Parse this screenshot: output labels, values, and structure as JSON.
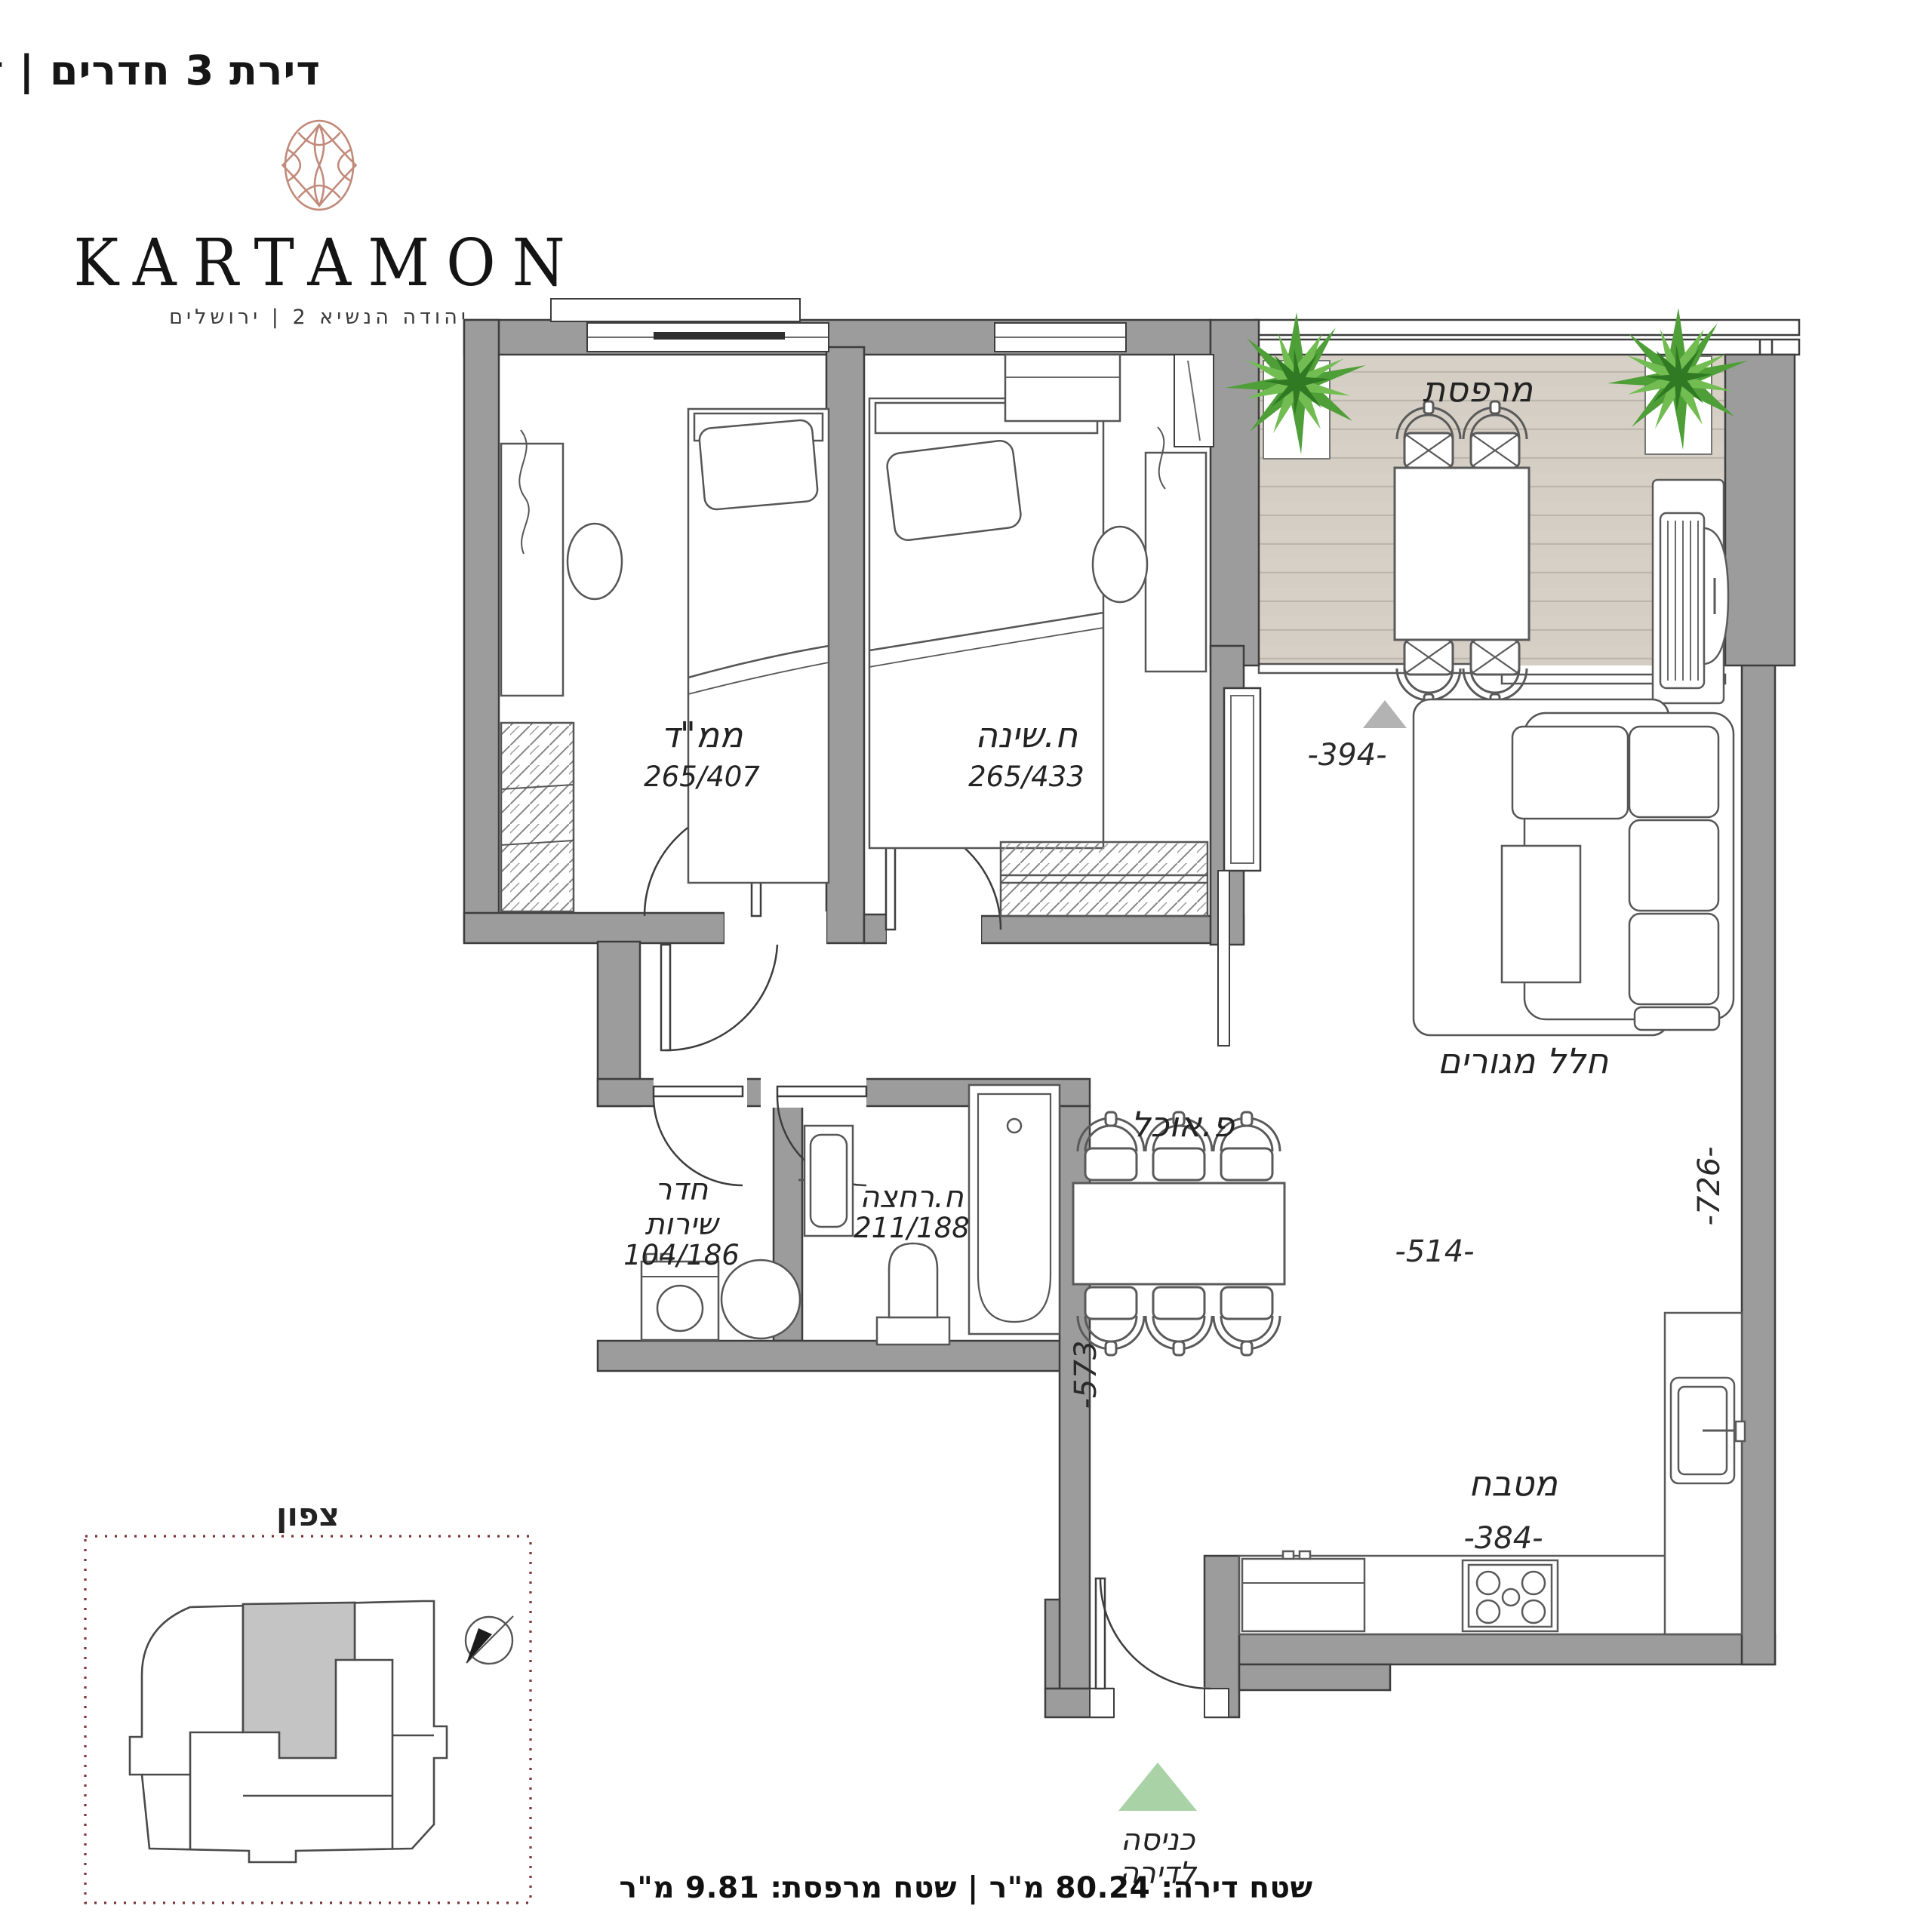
{
  "header": {
    "title": "דירת 3 חדרים | דגם A"
  },
  "logo": {
    "name": "KARTAMON",
    "subtitle": "יהודה הנשיא 2  |  ירושלים",
    "rosette_icon": "rosette-icon",
    "rosette_color": "#c18a7a"
  },
  "plan": {
    "rooms": {
      "mamad": {
        "name": "ממ\"ד",
        "dims": "265/407"
      },
      "bedroom": {
        "name": "ח.שינה",
        "dims": "265/433"
      },
      "balcony": {
        "name": "מרפסת"
      },
      "living": {
        "name": "חלל מגורים"
      },
      "dining": {
        "name": "פ.אוכל"
      },
      "utility": {
        "name_line1": "חדר",
        "name_line2": "שירות",
        "dims": "104/186"
      },
      "bath": {
        "name": "ח.רחצה",
        "dims": "211/188"
      },
      "kitchen": {
        "name": "מטבח"
      }
    },
    "dimensions": {
      "balcony_opening": "-394-",
      "living_depth": "-726-",
      "living_width": "-514-",
      "hall_depth": "-573",
      "kitchen_width": "-384-"
    },
    "entrance": {
      "line1": "כניסה",
      "line2": "לדירה",
      "marker_color": "#a9d3a7"
    },
    "north_label": "צפון",
    "colors": {
      "wall": "#9c9c9c",
      "deck": "#d6d0c7",
      "plant": "#4f9f38",
      "keyplan_border": "#7e3434"
    }
  },
  "footer": {
    "area_text": "שטח דירה: 80.24 מ\"ר | שטח מרפסת: 9.81 מ\"ר"
  }
}
